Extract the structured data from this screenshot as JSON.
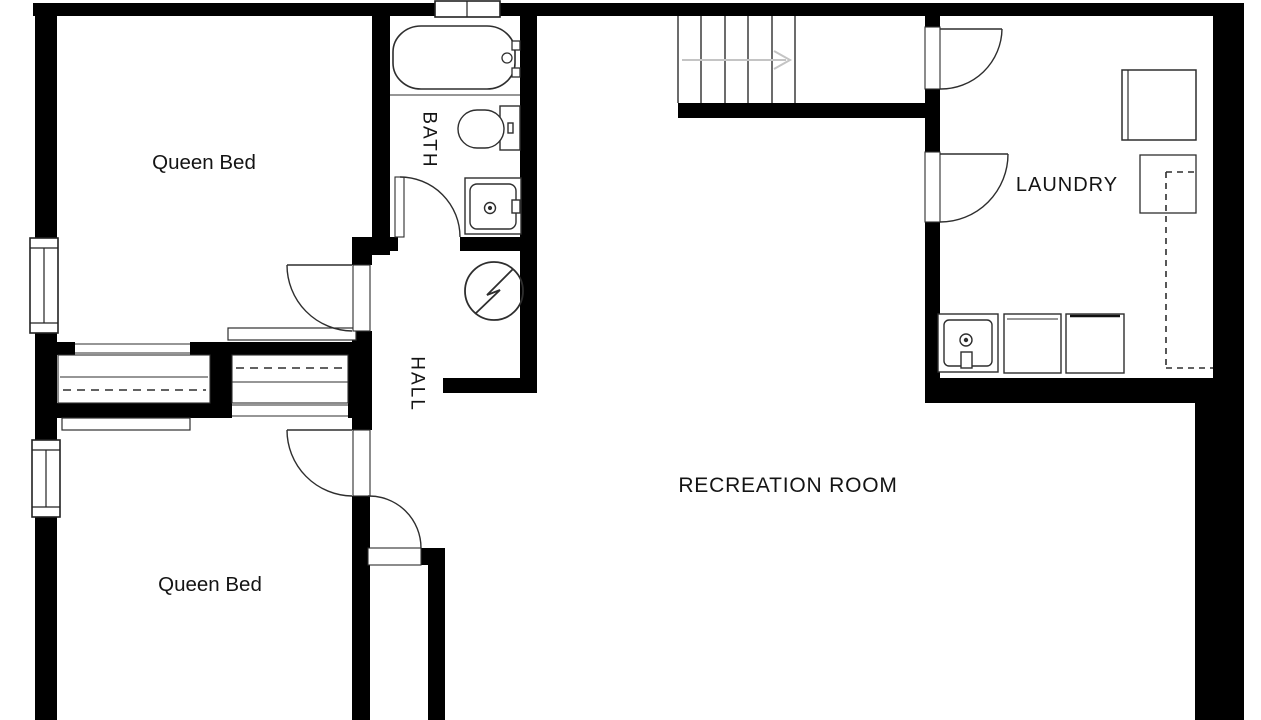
{
  "floor_plan": {
    "type": "residential-basement-floorplan",
    "background_color": "#ffffff",
    "wall_color": "#000000",
    "fixture_line_color": "#2e2e2e",
    "dashed_line_color": "#2e2e2e",
    "stair_arrow_color": "#c4c4c4",
    "rooms": {
      "bedroom_top": {
        "label": "Queen Bed"
      },
      "bedroom_bottom": {
        "label": "Queen Bed"
      },
      "bath": {
        "label": "BATH"
      },
      "hall": {
        "label": "HALL"
      },
      "recreation": {
        "label": "RECREATION ROOM"
      },
      "laundry": {
        "label": "LAUNDRY"
      }
    },
    "fixtures": [
      "bathtub",
      "tub-faucet",
      "toilet",
      "bathroom-sink",
      "electrical-panel",
      "stairs",
      "stair-direction-arrow",
      "laundry-sink",
      "washer",
      "dryer",
      "freezer",
      "dashed-utility-outline",
      "closet-rod-dashed",
      "sliding-closet-doors",
      "window",
      "door-swing-arc"
    ]
  }
}
